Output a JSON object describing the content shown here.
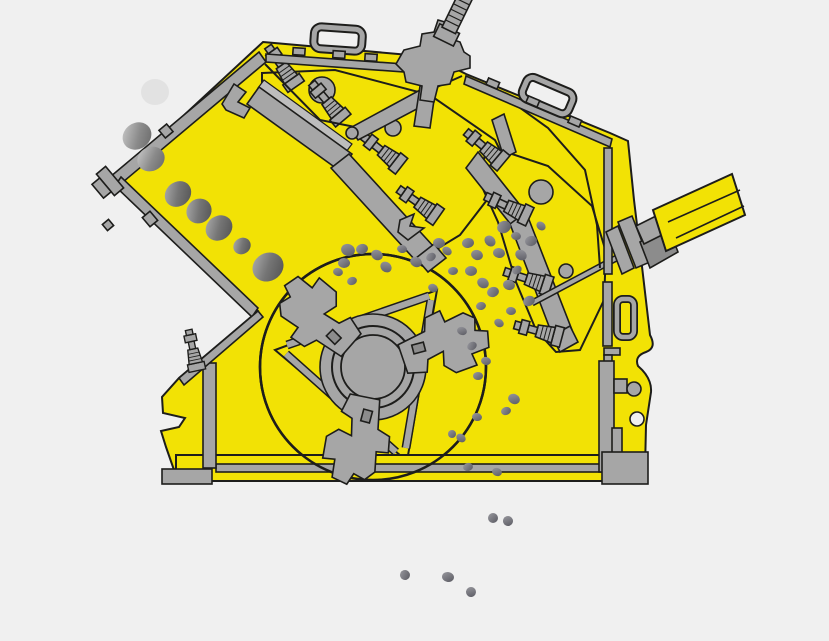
{
  "meta": {
    "description": "Cross-section schematic of an impact crusher: feed rocks slide down a left inlet chute, are struck by a three-hammer rotor between two spring-loaded impact aprons, and crushed pebbles discharge below the machine",
    "canvas": {
      "width": 829,
      "height": 641
    }
  },
  "colors": {
    "background": "#f0f0f0",
    "body": "#f2e205",
    "steel": "#a6a6a6",
    "steel_dark": "#8c8c8c",
    "steel_light": "#bdbdbd",
    "outline": "#1d1d1b",
    "rock_ghost": "#dedede"
  },
  "rocks": {
    "feed": [
      {
        "x": 155,
        "y": 92,
        "rx": 14,
        "ry": 13,
        "rot": 0,
        "shade": "ghost"
      },
      {
        "x": 137,
        "y": 136,
        "rx": 15,
        "ry": 13,
        "rot": -35,
        "shade": "mid"
      },
      {
        "x": 151,
        "y": 159,
        "rx": 14,
        "ry": 12,
        "rot": -25,
        "shade": "mid"
      },
      {
        "x": 178,
        "y": 194,
        "rx": 14,
        "ry": 12,
        "rot": -40,
        "shade": "dark"
      },
      {
        "x": 199,
        "y": 211,
        "rx": 13,
        "ry": 12,
        "rot": -40,
        "shade": "dark"
      },
      {
        "x": 219,
        "y": 228,
        "rx": 14,
        "ry": 12,
        "rot": -35,
        "shade": "dark"
      },
      {
        "x": 242,
        "y": 246,
        "rx": 9,
        "ry": 8,
        "rot": -35,
        "shade": "dark"
      },
      {
        "x": 268,
        "y": 267,
        "rx": 16,
        "ry": 14,
        "rot": -30,
        "shade": "dark"
      }
    ],
    "chamber": [
      {
        "x": 348,
        "y": 250,
        "rx": 7,
        "ry": 6,
        "rot": 20,
        "shade": "small"
      },
      {
        "x": 362,
        "y": 249,
        "rx": 6,
        "ry": 5,
        "rot": -15,
        "shade": "small"
      },
      {
        "x": 377,
        "y": 255,
        "rx": 6,
        "ry": 5,
        "rot": 30,
        "shade": "small"
      },
      {
        "x": 344,
        "y": 263,
        "rx": 6,
        "ry": 5,
        "rot": 0,
        "shade": "small"
      },
      {
        "x": 386,
        "y": 267,
        "rx": 6,
        "ry": 5,
        "rot": 40,
        "shade": "small"
      },
      {
        "x": 402,
        "y": 249,
        "rx": 5,
        "ry": 4,
        "rot": 10,
        "shade": "small"
      },
      {
        "x": 352,
        "y": 281,
        "rx": 5,
        "ry": 4,
        "rot": -20,
        "shade": "small"
      },
      {
        "x": 338,
        "y": 272,
        "rx": 5,
        "ry": 4,
        "rot": 15,
        "shade": "small"
      },
      {
        "x": 416,
        "y": 262,
        "rx": 6,
        "ry": 5,
        "rot": 25,
        "shade": "small"
      },
      {
        "x": 431,
        "y": 257,
        "rx": 5,
        "ry": 4,
        "rot": -30,
        "shade": "small"
      },
      {
        "x": 439,
        "y": 243,
        "rx": 6,
        "ry": 5,
        "rot": 5,
        "shade": "small"
      },
      {
        "x": 447,
        "y": 251,
        "rx": 5,
        "ry": 4,
        "rot": 35,
        "shade": "small"
      },
      {
        "x": 468,
        "y": 243,
        "rx": 6,
        "ry": 5,
        "rot": -10,
        "shade": "small"
      },
      {
        "x": 477,
        "y": 255,
        "rx": 6,
        "ry": 5,
        "rot": 20,
        "shade": "small"
      },
      {
        "x": 490,
        "y": 241,
        "rx": 6,
        "ry": 5,
        "rot": 45,
        "shade": "small"
      },
      {
        "x": 504,
        "y": 227,
        "rx": 7,
        "ry": 6,
        "rot": -25,
        "shade": "small"
      },
      {
        "x": 499,
        "y": 253,
        "rx": 6,
        "ry": 5,
        "rot": 10,
        "shade": "small"
      },
      {
        "x": 471,
        "y": 271,
        "rx": 6,
        "ry": 5,
        "rot": 0,
        "shade": "small"
      },
      {
        "x": 483,
        "y": 283,
        "rx": 6,
        "ry": 5,
        "rot": 30,
        "shade": "small"
      },
      {
        "x": 493,
        "y": 292,
        "rx": 6,
        "ry": 5,
        "rot": -20,
        "shade": "small"
      },
      {
        "x": 509,
        "y": 285,
        "rx": 6,
        "ry": 5,
        "rot": 15,
        "shade": "small"
      },
      {
        "x": 517,
        "y": 270,
        "rx": 5,
        "ry": 4,
        "rot": -35,
        "shade": "small"
      },
      {
        "x": 433,
        "y": 288,
        "rx": 5,
        "ry": 4,
        "rot": 25,
        "shade": "small"
      },
      {
        "x": 453,
        "y": 271,
        "rx": 5,
        "ry": 4,
        "rot": -5,
        "shade": "small"
      },
      {
        "x": 521,
        "y": 255,
        "rx": 6,
        "ry": 5,
        "rot": 35,
        "shade": "small"
      },
      {
        "x": 531,
        "y": 241,
        "rx": 6,
        "ry": 5,
        "rot": -15,
        "shade": "small"
      },
      {
        "x": 516,
        "y": 236,
        "rx": 5,
        "ry": 4,
        "rot": 10,
        "shade": "small"
      },
      {
        "x": 541,
        "y": 226,
        "rx": 5,
        "ry": 4,
        "rot": 40,
        "shade": "small"
      },
      {
        "x": 529,
        "y": 301,
        "rx": 6,
        "ry": 5,
        "rot": -25,
        "shade": "small"
      },
      {
        "x": 511,
        "y": 311,
        "rx": 5,
        "ry": 4,
        "rot": 5,
        "shade": "small"
      },
      {
        "x": 499,
        "y": 323,
        "rx": 5,
        "ry": 4,
        "rot": 30,
        "shade": "small"
      },
      {
        "x": 481,
        "y": 306,
        "rx": 5,
        "ry": 4,
        "rot": -10,
        "shade": "small"
      },
      {
        "x": 462,
        "y": 331,
        "rx": 5,
        "ry": 4,
        "rot": 20,
        "shade": "small"
      },
      {
        "x": 472,
        "y": 346,
        "rx": 5,
        "ry": 4,
        "rot": -30,
        "shade": "small"
      },
      {
        "x": 486,
        "y": 361,
        "rx": 5,
        "ry": 4,
        "rot": 15,
        "shade": "small"
      },
      {
        "x": 478,
        "y": 376,
        "rx": 5,
        "ry": 4,
        "rot": 0,
        "shade": "small"
      },
      {
        "x": 514,
        "y": 399,
        "rx": 6,
        "ry": 5,
        "rot": 25,
        "shade": "small"
      },
      {
        "x": 506,
        "y": 411,
        "rx": 5,
        "ry": 4,
        "rot": -20,
        "shade": "small"
      },
      {
        "x": 477,
        "y": 417,
        "rx": 5,
        "ry": 4,
        "rot": 10,
        "shade": "small"
      },
      {
        "x": 461,
        "y": 438,
        "rx": 5,
        "ry": 4,
        "rot": 35,
        "shade": "small"
      },
      {
        "x": 452,
        "y": 434,
        "rx": 4,
        "ry": 4,
        "rot": 0,
        "shade": "small"
      },
      {
        "x": 468,
        "y": 467,
        "rx": 5,
        "ry": 4,
        "rot": -15,
        "shade": "small"
      },
      {
        "x": 497,
        "y": 472,
        "rx": 5,
        "ry": 4,
        "rot": 20,
        "shade": "small"
      }
    ],
    "discharge": [
      {
        "x": 493,
        "y": 518,
        "rx": 5,
        "ry": 5,
        "rot": 0,
        "shade": "small"
      },
      {
        "x": 508,
        "y": 521,
        "rx": 5,
        "ry": 5,
        "rot": 25,
        "shade": "small"
      },
      {
        "x": 405,
        "y": 575,
        "rx": 5,
        "ry": 5,
        "rot": -20,
        "shade": "small"
      },
      {
        "x": 448,
        "y": 577,
        "rx": 6,
        "ry": 5,
        "rot": 10,
        "shade": "small"
      },
      {
        "x": 471,
        "y": 592,
        "rx": 5,
        "ry": 5,
        "rot": 30,
        "shade": "small"
      }
    ]
  }
}
